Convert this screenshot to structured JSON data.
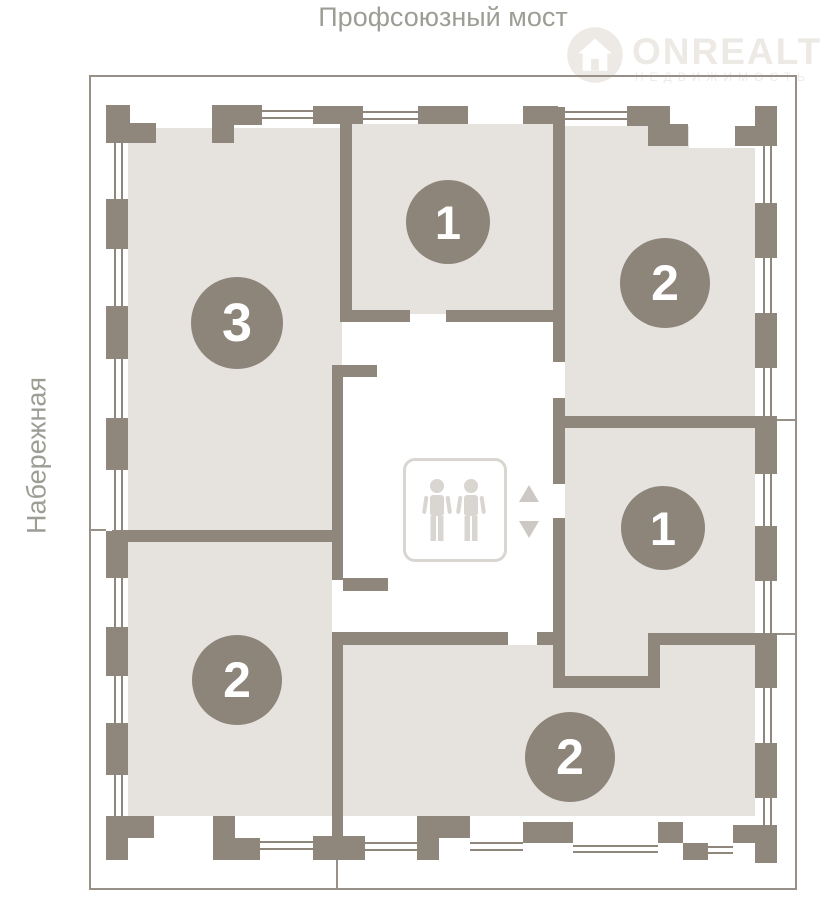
{
  "header": {
    "top_label": "Профсоюзный мост",
    "left_label": "Набережная"
  },
  "watermark": {
    "brand": "ONREALT",
    "tagline": "НЕДВИЖИМОСТЬ",
    "logo_icon": "house-in-circle"
  },
  "plan": {
    "units": [
      {
        "id": "unit-top-left",
        "rooms": "3"
      },
      {
        "id": "unit-top-middle",
        "rooms": "1"
      },
      {
        "id": "unit-top-right",
        "rooms": "2"
      },
      {
        "id": "unit-mid-right",
        "rooms": "1"
      },
      {
        "id": "unit-bottom-left",
        "rooms": "2"
      },
      {
        "id": "unit-bottom-right",
        "rooms": "2"
      }
    ],
    "elevator": {
      "icon": "elevator-two-persons",
      "arrows": [
        "up",
        "down"
      ]
    }
  },
  "colors": {
    "wall": "#8f867c",
    "room_fill": "#e6e2de",
    "badge": "#8d847a",
    "label_text": "#9d9d96",
    "frame_line": "#969089",
    "watermark": "#edeae6"
  }
}
